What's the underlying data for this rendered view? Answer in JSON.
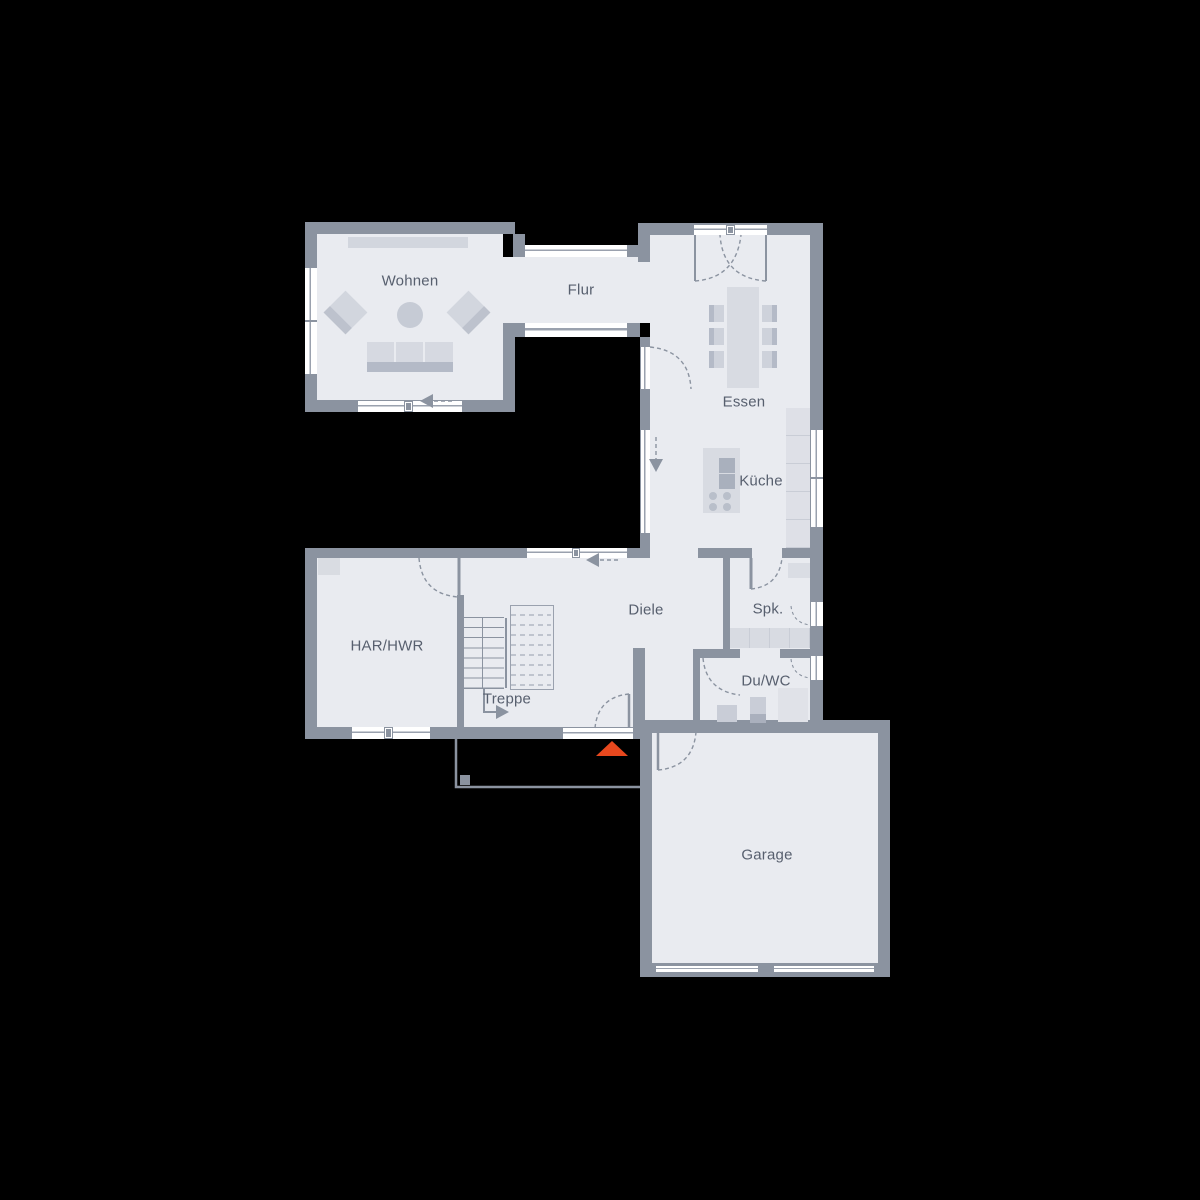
{
  "colors": {
    "background": "#000000",
    "wall": "#8b93a0",
    "floor": "#e9ebf0",
    "frame": "#9aa1ae",
    "label": "#575f6e",
    "furniture-light": "#d2d6de",
    "furniture-mid": "#c6cbd5",
    "furniture-dark": "#b4bac7",
    "entrance": "#e8481e"
  },
  "rooms": [
    {
      "id": "wohnen",
      "label": "Wohnen"
    },
    {
      "id": "flur",
      "label": "Flur"
    },
    {
      "id": "essen",
      "label": "Essen"
    },
    {
      "id": "kueche",
      "label": "Küche"
    },
    {
      "id": "diele",
      "label": "Diele"
    },
    {
      "id": "har-hwr",
      "label": "HAR/HWR"
    },
    {
      "id": "treppe",
      "label": "Treppe"
    },
    {
      "id": "spk",
      "label": "Spk."
    },
    {
      "id": "du-wc",
      "label": "Du/WC"
    },
    {
      "id": "garage",
      "label": "Garage"
    }
  ],
  "markers": {
    "entrance_arrow": "entrance-direction-triangle",
    "stair_direction": "up-arrow",
    "sliding_indicators": "dashed-arrows"
  }
}
